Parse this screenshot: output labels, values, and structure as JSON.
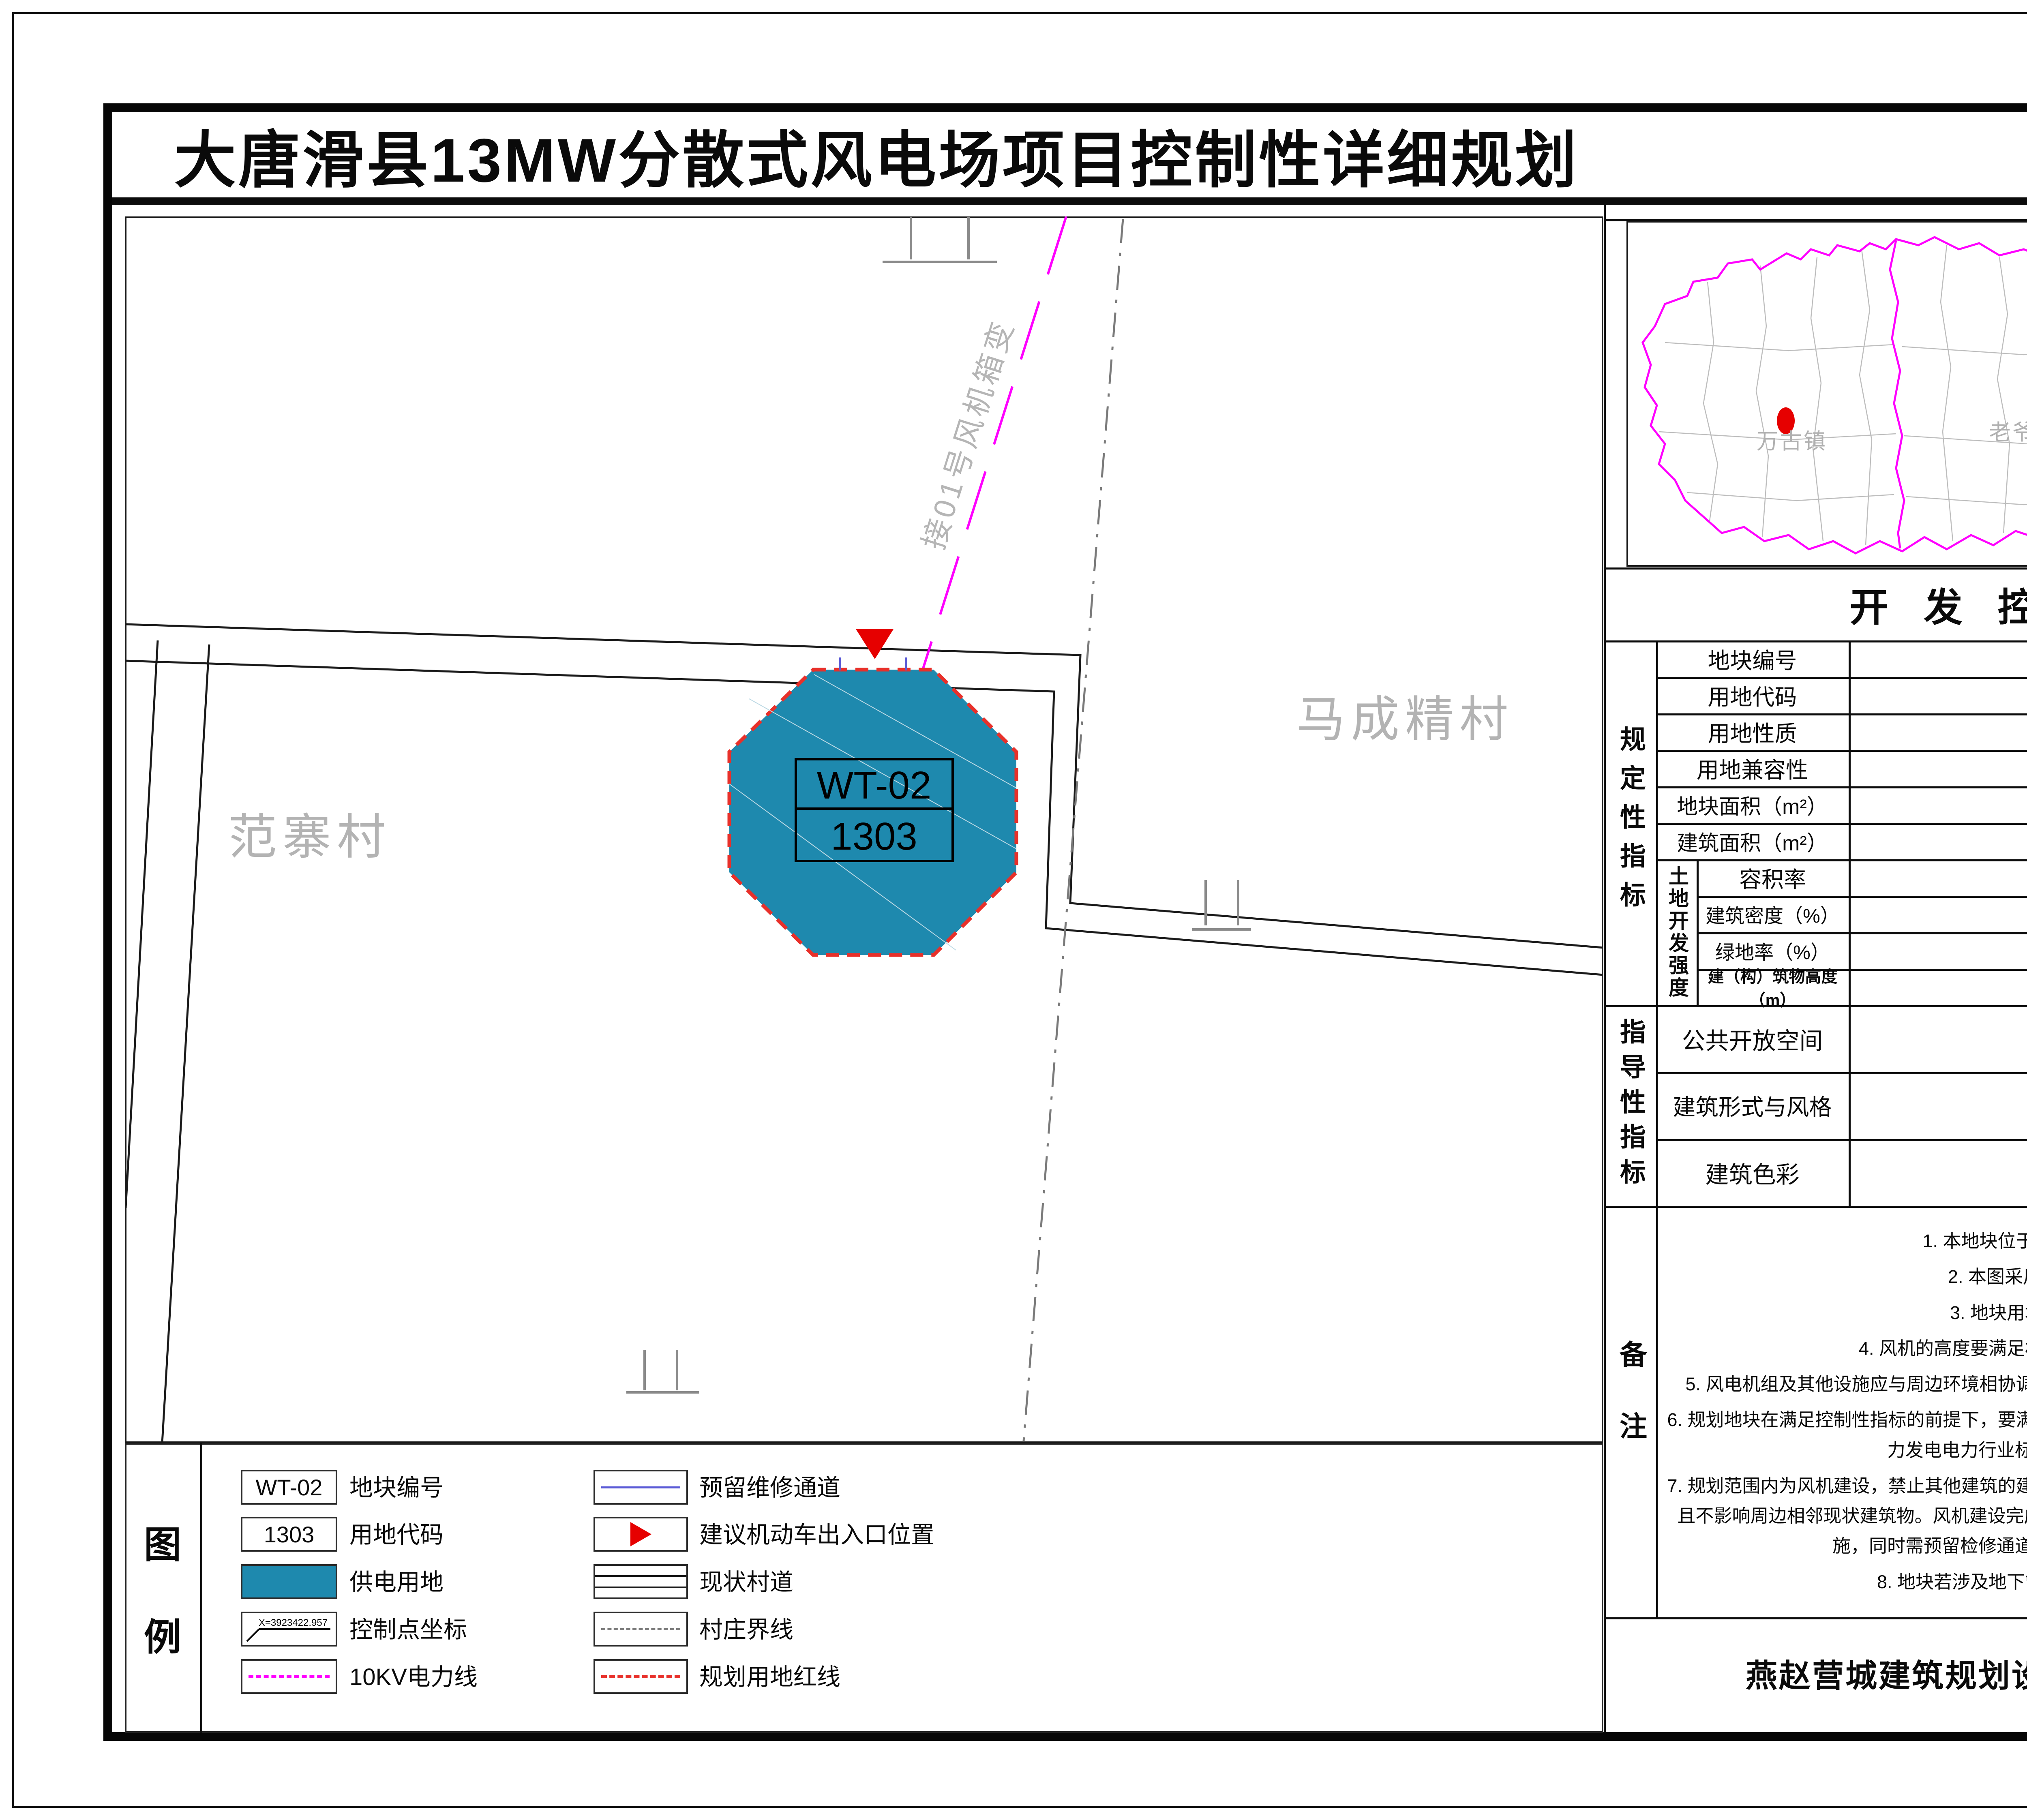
{
  "header": {
    "title": "大唐滑县13MW分散式风电场项目控制性详细规划",
    "sheet_type": "地块开发控制图则"
  },
  "map": {
    "village_left": "范寨村",
    "village_right": "马成精村",
    "plot": {
      "number": "WT-02",
      "code": "1303"
    },
    "power_line_label": "接01号风机箱变"
  },
  "location_panel": {
    "title": "地块位置",
    "north": "N",
    "town_left": "万古镇",
    "town_right": "老爷庙乡",
    "scale": {
      "above_left": "5",
      "above_right": "20m",
      "below_left": "0",
      "below_mid": "10"
    }
  },
  "indicators": {
    "title": "开 发 控 制 指 标",
    "groups": {
      "regulatory": "规定性指标",
      "guidance": "指导性指标",
      "notes": "备注",
      "land_intensity": "土地开发强度"
    },
    "rows": [
      {
        "label": "地块编号",
        "value": "WT-02"
      },
      {
        "label": "用地代码",
        "value": "1303"
      },
      {
        "label": "用地性质",
        "value": "供电用地"
      },
      {
        "label": "用地兼容性",
        "value": "--"
      },
      {
        "label": "地块面积（m²）",
        "value": "311.34"
      },
      {
        "label": "建筑面积（m²）",
        "value": "--"
      }
    ],
    "land_rows": [
      {
        "label": "容积率",
        "value": "--"
      },
      {
        "label": "建筑密度（%）",
        "value": "--"
      },
      {
        "label": "绿地率（%）",
        "value": "--"
      },
      {
        "label": "建（构）筑物高度（m）",
        "value": "≤210"
      }
    ],
    "guidance_rows": [
      {
        "label": "公共开放空间",
        "value": "--"
      },
      {
        "label": "建筑形式与风格",
        "value": "--"
      },
      {
        "label": "建筑色彩",
        "value": "--"
      }
    ],
    "notes": [
      "1. 本地块位于滑县万古镇范寨村东北部；",
      "2. 本图采用2000国家大地坐标系；",
      "3. 地块用地面积以土地实测为准；",
      "4. 风机的高度要满足相关技术规范及当地净空保护要求；",
      "5. 风电机组及其他设施应与周边环境相协调，减少对周边农田、生产设施等的干扰，确保生产安全；",
      "6. 规划地块在满足控制性指标的前提下，要满足相关技术规范要求。同时还应满足风力发电国家标准、风力发电电力行业标准及风力发电机械行业标准等；",
      "7. 规划范围内为风机建设，禁止其他建筑的建设，建筑物、构筑物需在基地内建设，不得超出用地范围，且不影响周边相邻现状建筑物。风机建设完成后要及时恢复周边破坏植被以及生产路、排水沟等农业设施，同时需预留检修通道，具体位置根据现状情况可进行调整；",
      "8. 地块若涉及地下管线、文物须征求相关部门意见。"
    ]
  },
  "legend": {
    "title_char1": "图",
    "title_char2": "例",
    "left": [
      {
        "sample": "WT-02",
        "label": "地块编号"
      },
      {
        "sample": "1303",
        "label": "用地代码"
      },
      {
        "sample": "",
        "label": "供电用地"
      },
      {
        "sample": "X=3923422.957",
        "label": "控制点坐标"
      },
      {
        "sample": "",
        "label": "10KV电力线"
      }
    ],
    "right": [
      {
        "label": "预留维修通道"
      },
      {
        "label": "建议机动车出入口位置"
      },
      {
        "label": "现状村道"
      },
      {
        "label": "村庄界线"
      },
      {
        "label": "规划用地红线"
      }
    ]
  },
  "footer": {
    "company": "燕赵营城建筑规划设计有限公司",
    "date": "2025年12月",
    "sheet_no": "WT-02"
  },
  "colors": {
    "plot_fill": "#1E89AE",
    "red_line": "#E8302A",
    "entrance_red": "#E60000",
    "power_line": "#FF00FF",
    "boundary_gray": "#7A7A7A",
    "muted_text": "#B3B3B3",
    "header_bg": "#57575A",
    "maintenance_blue": "#5B5BD6"
  }
}
